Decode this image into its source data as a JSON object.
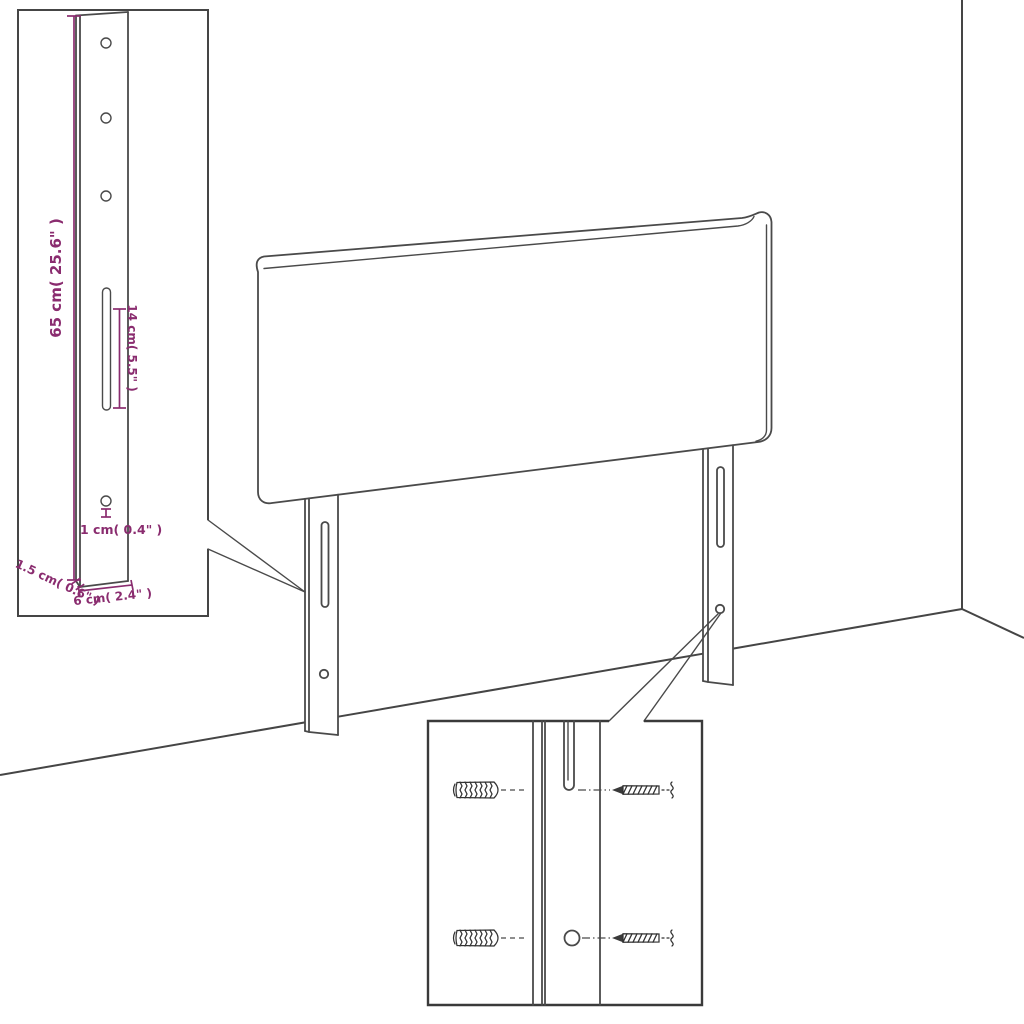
{
  "diagram": {
    "type": "headboard-dimension-diagram",
    "colors": {
      "line": "#4a4a4a",
      "dimension": "#8A2C6F",
      "background": "#ffffff"
    },
    "dimensions": {
      "leg_height": "65 cm( 25.6\" )",
      "slot_length": "14 cm( 5.5\" )",
      "hole_diameter": "1 cm( 0.4\" )",
      "leg_thickness": "1.5 cm( 0.6\" )",
      "leg_width": "6 cm( 2.4\" )"
    }
  }
}
